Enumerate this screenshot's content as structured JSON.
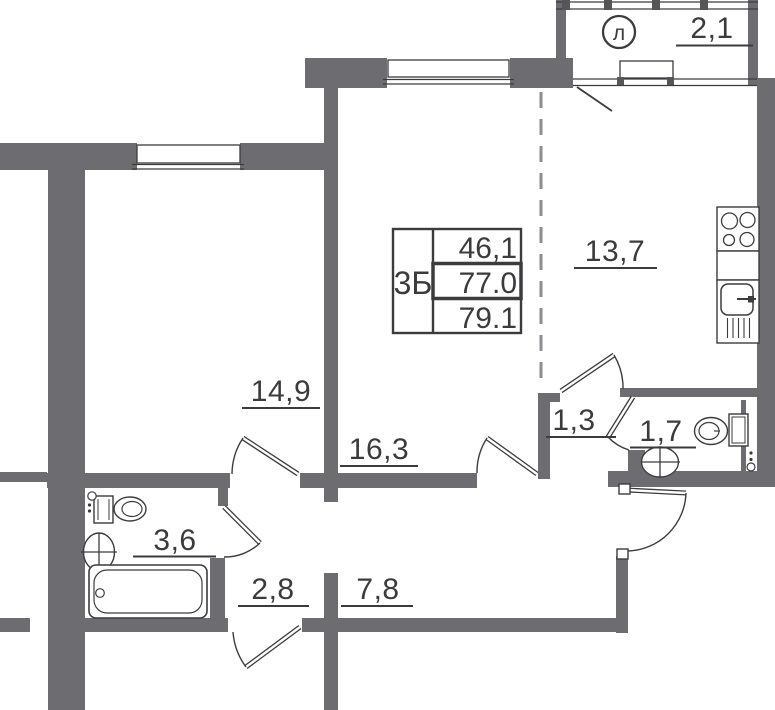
{
  "plan": {
    "title": "apartment floor plan",
    "table": {
      "type": "3Б",
      "row1": "46,1",
      "row2": "77.0",
      "row3": "79.1"
    },
    "labels": {
      "loggia_symbol": "л",
      "loggia": "2,1",
      "kitchen": "13,7",
      "bedroom": "14,9",
      "living": "16,3",
      "corridor_small": "1,3",
      "wc": "1,7",
      "bathroom": "3,6",
      "hall": "2,8",
      "hallway": "7,8"
    },
    "colors": {
      "wall": "#6d6d71",
      "line": "#3c3c3e",
      "dashed": "#8d8d91",
      "text": "#3b3b3d",
      "background": "#ffffff"
    }
  }
}
